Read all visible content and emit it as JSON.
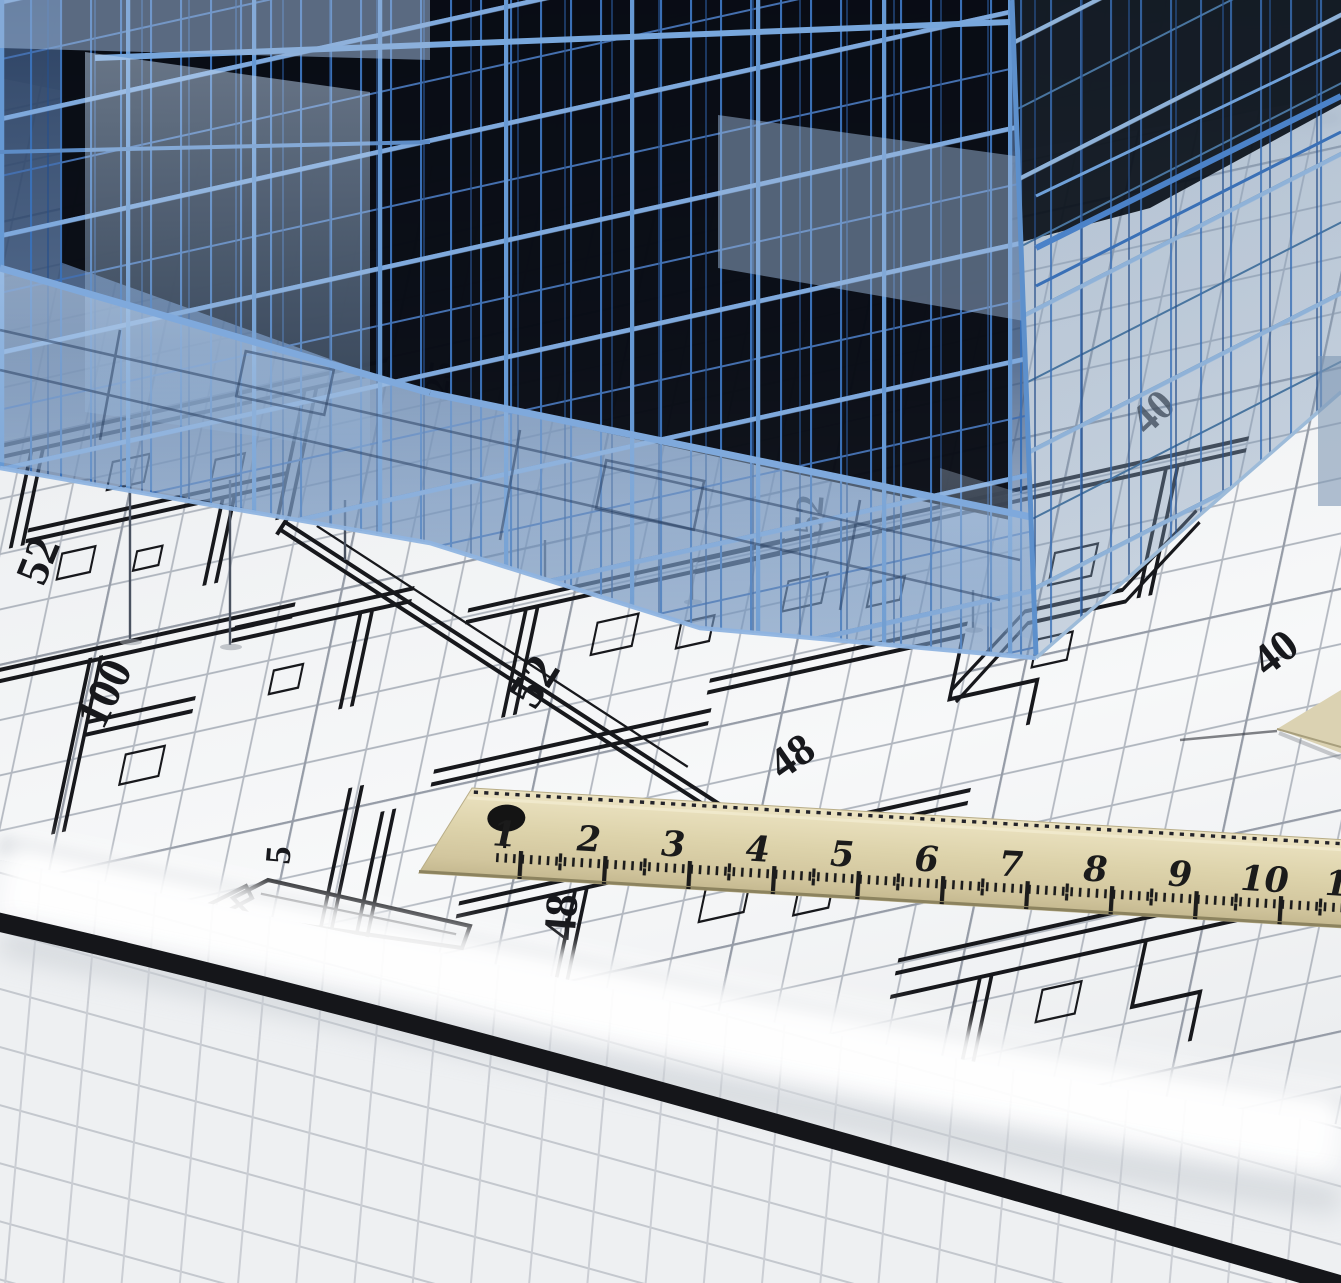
{
  "scene": {
    "subject": "3D blue wireframe building model standing on rolled architectural blueprint sheets with a wooden ruler",
    "style": "photographic 3d render, no UI chrome"
  },
  "colors": {
    "paper": "#f2f3f5",
    "backdrop_gray": "#9aa3ad",
    "grid_line": "#aeb4bd",
    "grid_line_bold": "#969ca7",
    "ink": "#17181c",
    "building_line": "#3a70b6",
    "building_line_light": "#7fa9dc",
    "building_glass": "#a9c6e6",
    "building_void": "#06090f",
    "ruler_wood": "#ddd3ab",
    "ruler_ink": "#1b1b1b",
    "roll_highlight": "#ffffff"
  },
  "blueprint": {
    "labels": [
      {
        "id": "left-52",
        "text": "52"
      },
      {
        "id": "left-100",
        "text": "100"
      },
      {
        "id": "mid-52",
        "text": "52"
      },
      {
        "id": "mid-48",
        "text": "48"
      },
      {
        "id": "right-40",
        "text": "40"
      },
      {
        "id": "small-5",
        "text": "5"
      },
      {
        "id": "under-ruler-48",
        "text": "48"
      },
      {
        "id": "glass-40",
        "text": "40"
      },
      {
        "id": "glass-52",
        "text": "52"
      },
      {
        "id": "glass-25",
        "text": "25"
      }
    ]
  },
  "ruler": {
    "unit_labels": [
      "1",
      "2",
      "3",
      "4",
      "5",
      "6",
      "7",
      "8",
      "9",
      "10",
      "11"
    ]
  }
}
